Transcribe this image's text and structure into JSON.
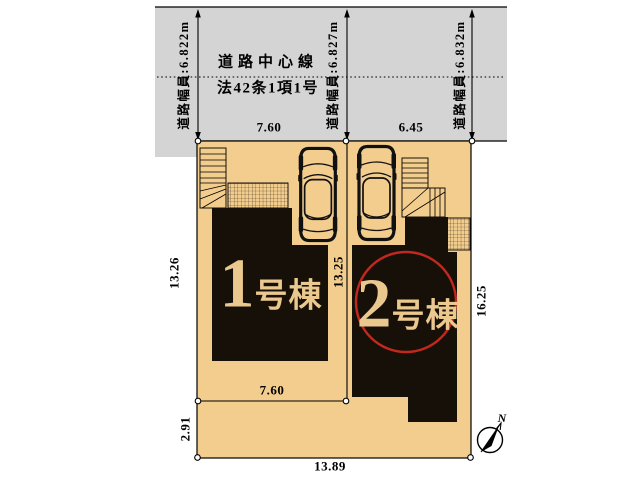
{
  "road": {
    "center_line_label": "道路中心線",
    "law_reference_label": "法42条1項1号",
    "width_labels": [
      {
        "text": "道路幅員:6.822m"
      },
      {
        "text": "道路幅員:6.827m"
      },
      {
        "text": "道路幅員:6.832m"
      }
    ]
  },
  "dimensions": {
    "top_lot1_width": "7.60",
    "top_lot2_width": "6.45",
    "lot1_left_depth": "13.26",
    "lot_divider_depth": "13.25",
    "lot2_right_depth": "16.25",
    "lot1_bottom_width": "7.60",
    "bottom_left_depth": "2.91",
    "bottom_total_width": "13.89"
  },
  "buildings": [
    {
      "number": "1",
      "suffix": "号棟",
      "highlighted": false
    },
    {
      "number": "2",
      "suffix": "号棟",
      "highlighted": true
    }
  ],
  "compass": {
    "north_label": "N"
  },
  "colors": {
    "road": "#d4d4d4",
    "lot": "#f2cd8e",
    "building": "#171009",
    "building_text": "#eac88e",
    "highlight_ring": "#c2281c"
  }
}
